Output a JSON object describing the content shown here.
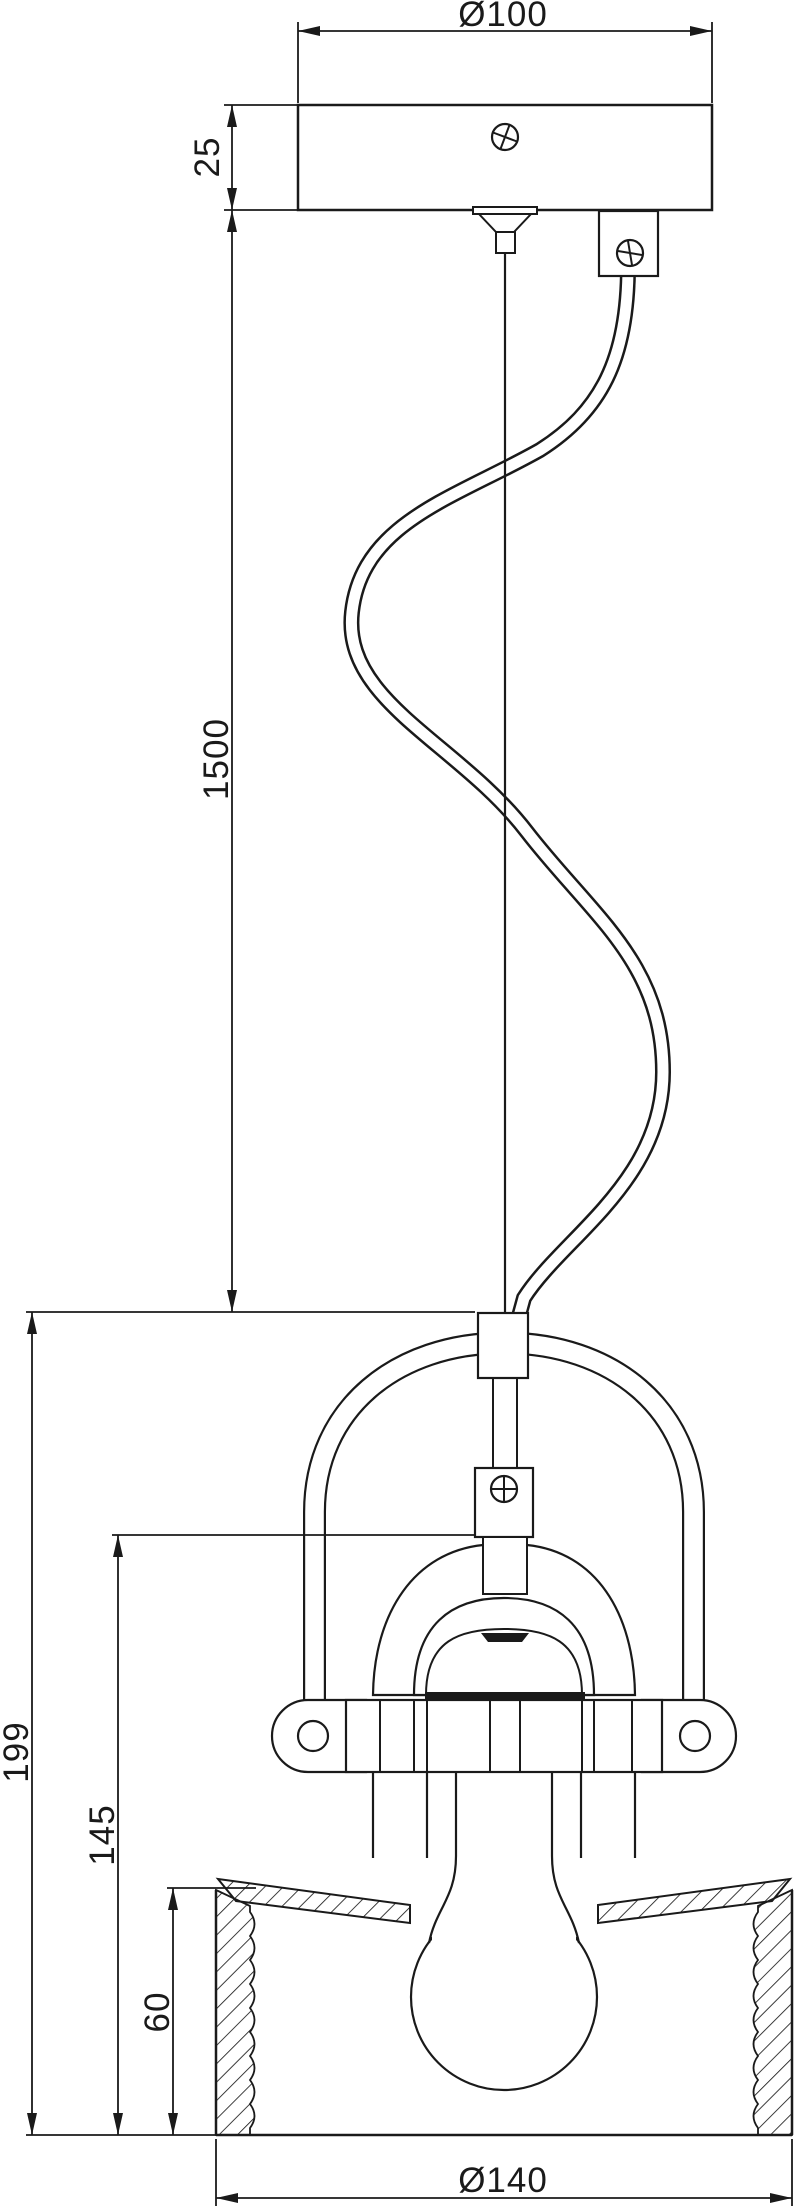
{
  "colors": {
    "background": "#ffffff",
    "line": "#1a1a1a"
  },
  "dimensions": {
    "canopy_diameter": "Ø100",
    "canopy_height": "25",
    "cable_length": "1500",
    "fixture_height": "199",
    "shade_assembly_height": "145",
    "band_height": "60",
    "shade_diameter": "Ø140"
  }
}
